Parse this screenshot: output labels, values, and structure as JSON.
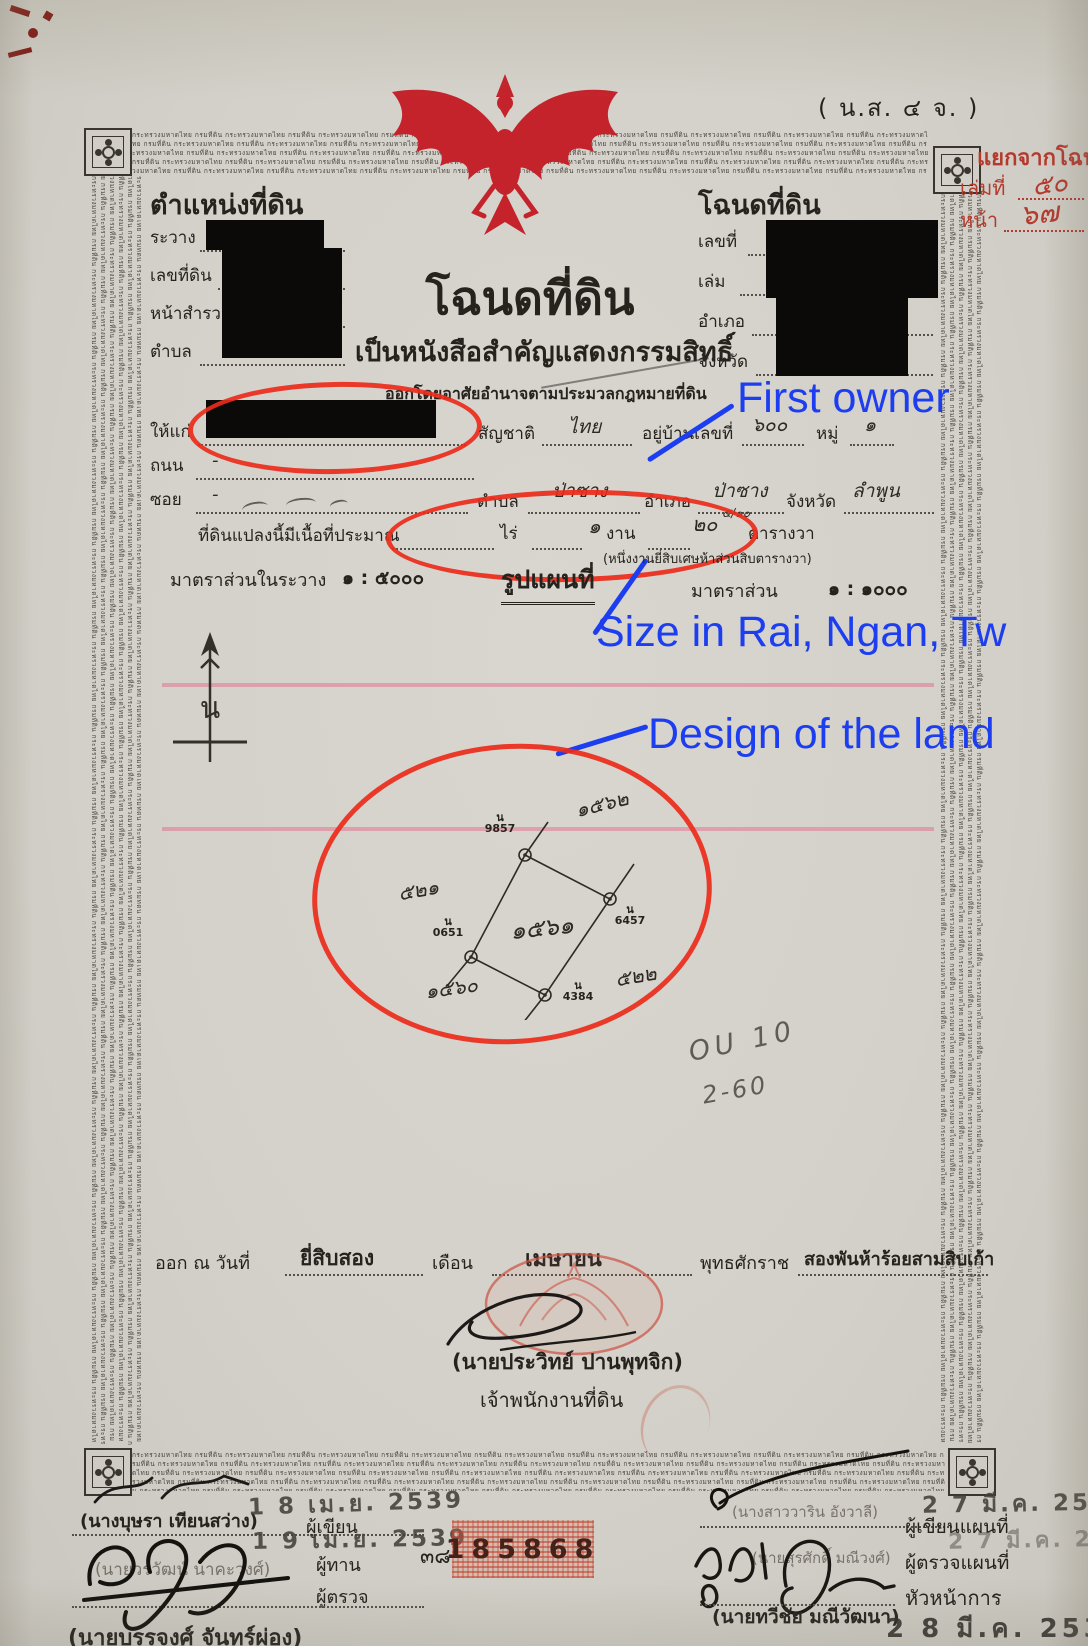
{
  "annotations": {
    "first_owner_label": "First owner",
    "size_label": "Size in Rai, Ngan, Tw",
    "design_label": "Design of the land",
    "accent_blue": "#1c3ef0",
    "accent_red": "#ec2b1b"
  },
  "corner_code": "( น.ส. ๔ จ. )",
  "margin_note": {
    "line1": "แยกจากโฉนด",
    "book_label": "เล่มที่",
    "book_value": "๕๐",
    "page_label": "หน้า",
    "page_value": "๖๗"
  },
  "border_text": "กระทรวงมหาดไทย กรมที่ดิน ",
  "position_block": {
    "title": "ตำแหน่งที่ดิน",
    "field1": "ระวาง",
    "field2": "เลขที่ดิน",
    "field3": "หน้าสำรวจ",
    "field4": "ตำบล"
  },
  "deed_block": {
    "title": "โฉนดที่ดิน",
    "field1": "เลขที่",
    "field2": "เล่ม",
    "field3": "อำเภอ",
    "field4": "จังหวัด"
  },
  "title_block": {
    "main": "โฉนดที่ดิน",
    "subtitle": "เป็นหนังสือสำคัญแสดงกรรมสิทธิ์",
    "authority_line": "ออกโดยอาศัยอำนาจตามประมวลกฎหมายที่ดิน"
  },
  "owner_row": {
    "grant_label": "ให้แก่",
    "nationality_label": "สัญชาติ",
    "nationality_value": "ไทย",
    "house_label": "อยู่บ้านเลขที่",
    "house_value": "๖๐๐",
    "moo_label": "หมู่",
    "moo_value": "๑"
  },
  "road_row": {
    "label": "ถนน",
    "value": "-"
  },
  "soi_row": {
    "label": "ซอย",
    "value": "-",
    "tambon_label": "ตำบล",
    "tambon_value": "ป่าซาง",
    "amphoe_label": "อำเภอ",
    "amphoe_value": "ป่าซาง",
    "province_label": "จังหวัด",
    "province_value": "ลำพูน"
  },
  "area_row": {
    "label": "ที่ดินแปลงนี้มีเนื้อที่ประมาณ",
    "rai_label": "ไร่",
    "ngan_value": "๑",
    "ngan_label": "งาน",
    "wa_value": "๒๐",
    "wa_fraction": "๕/๑๐",
    "wa_label": "ตารางวา",
    "spelled_out": "(หนึ่งงานยี่สิบเศษห้าส่วนสิบตารางวา)"
  },
  "scale_row": {
    "survey_label": "มาตราส่วนในระวาง",
    "survey_value": "๑ : ๕๐๐๐",
    "map_title": "รูปแผนที่",
    "map_scale_label": "มาตราส่วน",
    "map_scale_value": "๑ : ๑๐๐๐"
  },
  "north_letter": "น",
  "plot": {
    "marker_prefix": "น",
    "top_marker": "9857",
    "right_marker": "6457",
    "bottom_marker": "4384",
    "left_marker": "0651",
    "parcel_number": "๑๕๖๑",
    "neighbor_top": "๑๕๖๒",
    "neighbor_left": "๕๒๑",
    "neighbor_right": "๕๒๒",
    "neighbor_bottom": "๑๕๖๐"
  },
  "pencil_note": {
    "line1": "OU 10",
    "line2": "2-60"
  },
  "issue_row": {
    "prefix": "ออก ณ วันที่",
    "day_value": "ยี่สิบสอง",
    "month_label": "เดือน",
    "month_value": "เมษายน",
    "era_label": "พุทธศักราช",
    "year_value": "สองพันห้าร้อยสามสิบเก้า"
  },
  "issuer": {
    "name": "(นายประวิทย์ ปานพุทจิก)",
    "title": "เจ้าพนักงานที่ดิน"
  },
  "serial_number": "185868",
  "bottom_left": {
    "name1": "(นางบุษรา เทียนสว่าง)",
    "date_stamp1": "1 8 เม.ย. 2539",
    "role1": "ผู้เขียน",
    "date_stamp2": "1 9 เม.ย. 2539",
    "role2": "ผู้ทาน",
    "sheet_number": "๓๘",
    "name2": "(นายวรวัฒน์ นาคะวงศ์)",
    "role3": "ผู้ตรวจ",
    "name3": "(นายบรรจงศ์ จันทร์ผ่อง)"
  },
  "bottom_right": {
    "name1": "(นางสาววาริน อังวาลี)",
    "date_stamp1": "2 7 มี.ค. 2539",
    "role1": "ผู้เขียนแผนที่",
    "date_stamp2": "2 7 มี.ค. 2539",
    "role2": "ผู้ตรวจแผนที่",
    "name2": "(นายสุรศักดิ์ มณีวงศ์)",
    "role3": "หัวหน้าการ",
    "name3": "(นายทวีชัย มณีวัฒนา)",
    "date_stamp3": "2 8 มี.ค. 2539"
  }
}
